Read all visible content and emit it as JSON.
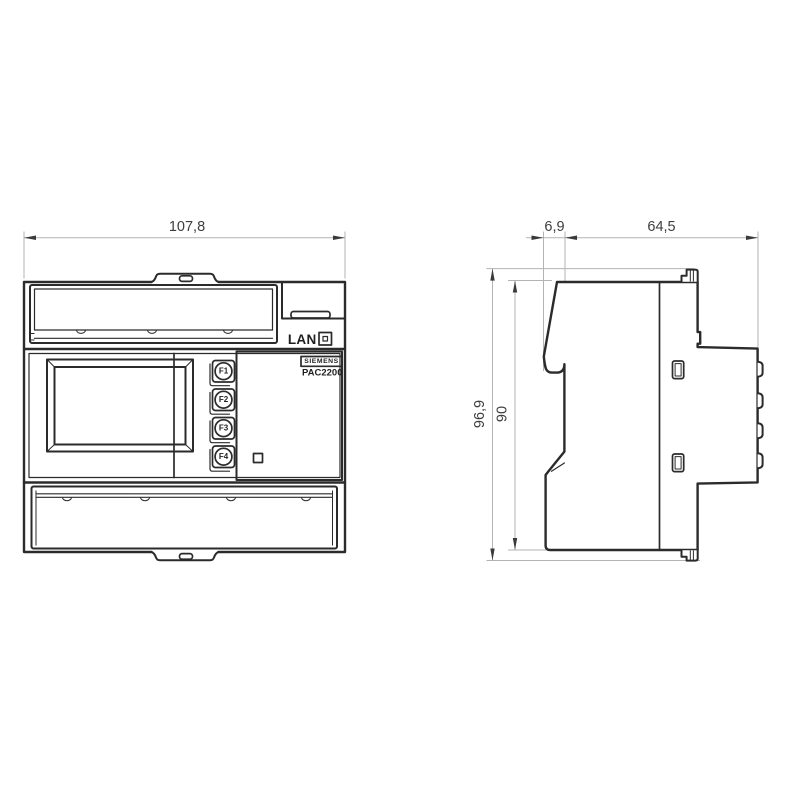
{
  "front_view": {
    "width_dim": "107,8",
    "lan_label": "LAN",
    "brand": "SIEMENS",
    "model": "PAC2200",
    "function_buttons": [
      {
        "label": "F1"
      },
      {
        "label": "F2"
      },
      {
        "label": "F3"
      },
      {
        "label": "F4"
      }
    ]
  },
  "side_view": {
    "front_depth_dim": "6,9",
    "body_depth_dim": "64,5",
    "overall_height_dim": "96,9",
    "body_height_dim": "90"
  },
  "colors": {
    "outline": "#2b2b2b",
    "dimension_line": "#b3b3b3",
    "dimension_text": "#3d3d3d",
    "background": "#ffffff"
  }
}
